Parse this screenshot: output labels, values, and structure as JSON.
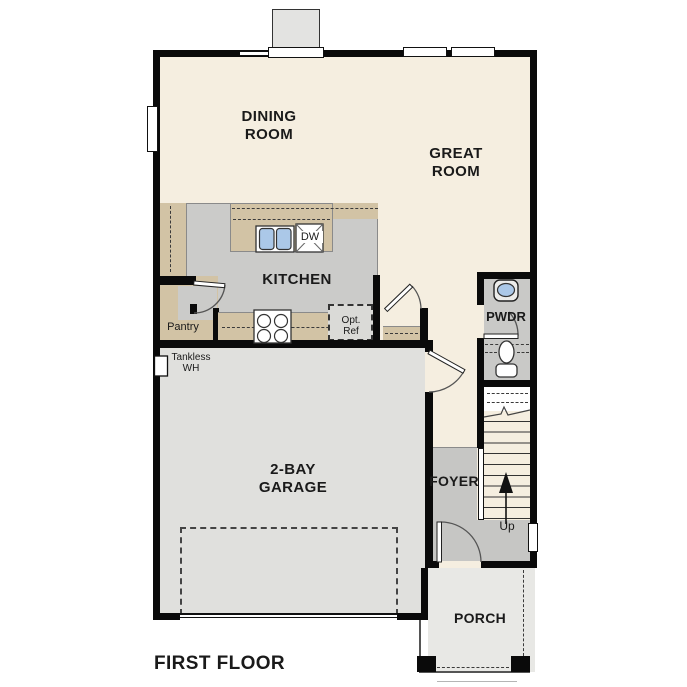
{
  "title": "FIRST FLOOR",
  "rooms": {
    "dining_room": "DINING\nROOM",
    "great_room": "GREAT\nROOM",
    "kitchen": "KITCHEN",
    "pantry": "Pantry",
    "garage": "2-BAY\nGARAGE",
    "foyer": "FOYER",
    "powder_room": "PWDR",
    "porch": "PORCH"
  },
  "fixtures": {
    "dishwasher": "DW",
    "optional_refrigerator": "Opt.\nRef",
    "tankless_water_heater": "Tankless\nWH",
    "stairs_direction": "Up"
  },
  "colors": {
    "wall": "#0a0a0a",
    "cream": "#f5eee0",
    "tan": "#d2c3a5",
    "kitchenGray": "#cbcbc9",
    "foyerGray": "#c6c6c4",
    "pwdrGray": "#c9c9c7",
    "garageGray": "#e0e0dd",
    "porchGray": "#e8e8e5",
    "chimneyGray": "#e3e3e1",
    "applianceGray": "#dadad7",
    "sinkBlue": "#abc8e8"
  }
}
